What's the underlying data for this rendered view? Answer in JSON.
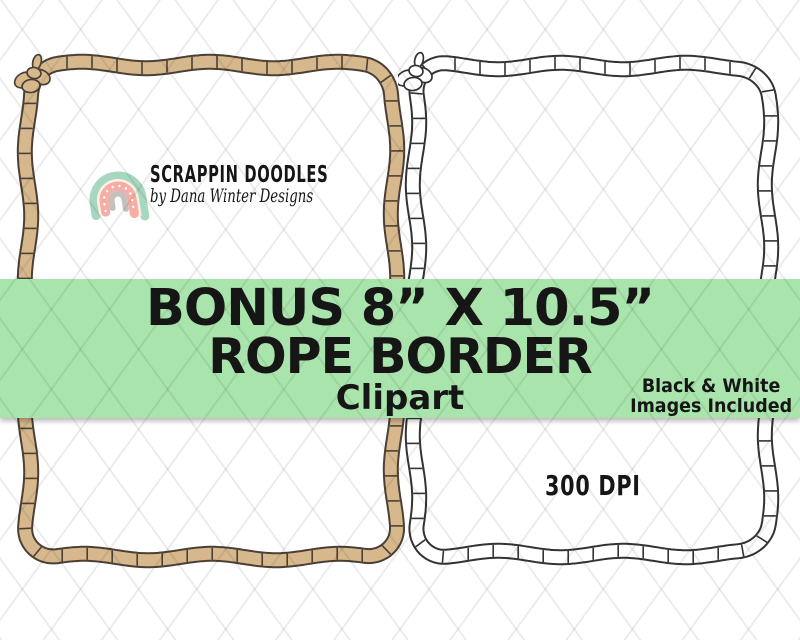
{
  "logo": {
    "brand": "SCRAPPIN DOODLES",
    "byline": "by Dana Winter Designs",
    "colors": {
      "arc_outer": "#a6d7bf",
      "arc_cream": "#fbf1e4",
      "arc_pink": "#f5ada6",
      "arc_inner_gray": "#c6c0ba",
      "dots": "#ffffff"
    }
  },
  "banner": {
    "background_color": "#a8e4ab",
    "text_color": "#161616",
    "line1": "BONUS 8” X 10.5”",
    "line2": "ROPE BORDER",
    "line3": "Clipart",
    "note_line1": "Black & White",
    "note_line2": "Images Included"
  },
  "frames": {
    "left": {
      "style": "colored",
      "rope_fill": "#d7b78c",
      "rope_outline": "#4a4036"
    },
    "right": {
      "style": "black-white",
      "rope_fill": "#ffffff",
      "rope_outline": "#333333"
    }
  },
  "dpi_label": "300 DPI",
  "watermark": {
    "pattern": "diamond-lattice",
    "line_color": "rgba(0,0,0,0.075)"
  }
}
